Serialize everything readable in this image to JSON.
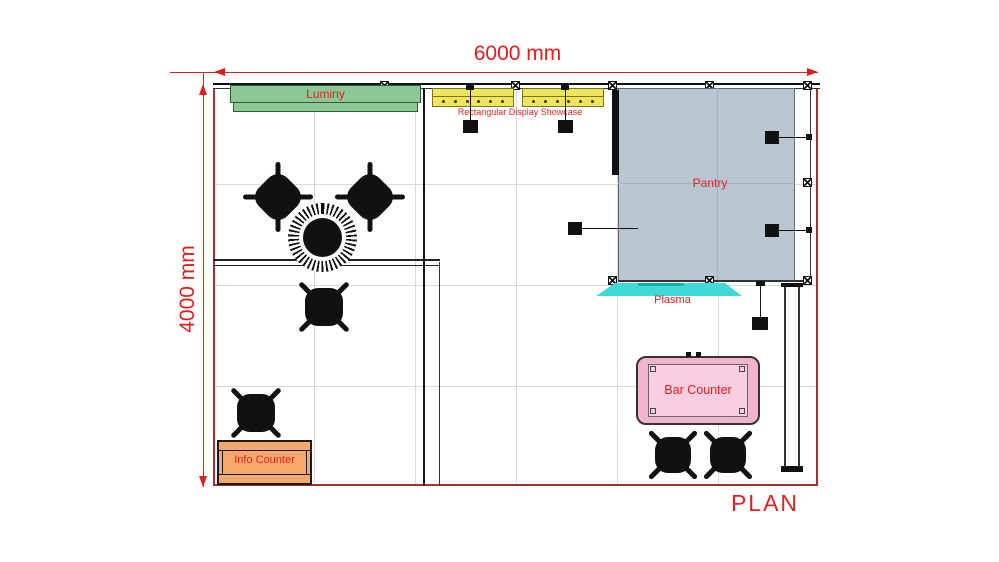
{
  "title_label": "PLAN",
  "dimensions": {
    "width": "6000 mm",
    "height": "4000 mm"
  },
  "labels": {
    "luminy": "Luminy",
    "showcase": "Rectangular Display Showcase",
    "pantry": "Pantry",
    "plasma": "Plasma",
    "bar_counter": "Bar Counter",
    "info_counter": "Info Counter"
  },
  "colors": {
    "label_red": "#e02222",
    "dimension_red": "#e01c1c",
    "plan_border_maroon": "#9c3434",
    "luminy_green": "#8cc795",
    "showcase_yellow": "#eee45e",
    "pantry_blue_gray": "#b9c6d2",
    "plasma_cyan": "#3fd9d9",
    "bar_counter_pink": "#f2b3cf",
    "info_counter_orange": "#f6a96b",
    "furniture_black": "#111111"
  },
  "furniture": {
    "chairs": 6,
    "round_tables": 1
  }
}
